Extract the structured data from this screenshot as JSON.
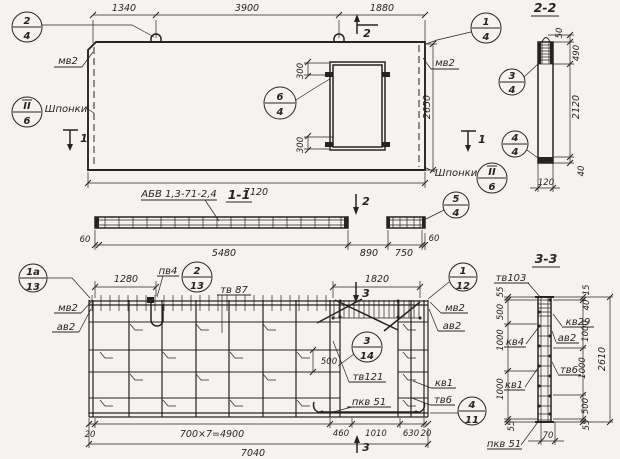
{
  "colors": {
    "ink": "#26241f",
    "paper": "#f4f3ef"
  },
  "plan_view": {
    "dims_top": [
      "1340",
      "3900",
      "1880"
    ],
    "dim_width": "7120",
    "dim_height": "2650",
    "dim_opening": [
      "300",
      "300"
    ],
    "label_mv2": "мв2",
    "label_keys_left": "Шпонки",
    "label_keys_right": "Шпонки",
    "callout_left": {
      "top": "2",
      "bottom": "4"
    },
    "callout_right": {
      "top": "1",
      "bottom": "4"
    },
    "callout_opening": {
      "top": "6",
      "bottom": "4"
    },
    "callout_keys": {
      "top": "II",
      "bottom": "6"
    },
    "cut1": "1",
    "cut2": "2"
  },
  "section_1_1": {
    "title": "1-1",
    "ref": "АБВ 1,3-71-2,4",
    "dims": [
      "60",
      "5480",
      "890",
      "750",
      "60"
    ],
    "callout": {
      "top": "5",
      "bottom": "4"
    }
  },
  "section_2_2": {
    "title": "2-2",
    "dims": {
      "d50": "50",
      "d490": "490",
      "d2120": "2120",
      "d40": "40",
      "d120": "120"
    },
    "callout_top": {
      "top": "3",
      "bottom": "4"
    },
    "callout_bottom": {
      "top": "4",
      "bottom": "4"
    }
  },
  "rebar_plan": {
    "dim_1280": "1280",
    "dim_1820": "1820",
    "dim_500": "500",
    "label_pv4": "пв4",
    "label_tv87": "тв 87",
    "label_tv121": "тв121",
    "label_kv1": "кв1",
    "label_tv6": "тв6",
    "label_pkv51": "пкв 51",
    "label_mv2": "мв2",
    "label_av2": "ав2",
    "callout_1a": {
      "top": "1а",
      "bottom": "13"
    },
    "callout_2": {
      "top": "2",
      "bottom": "13"
    },
    "callout_1": {
      "top": "1",
      "bottom": "12"
    },
    "callout_3": {
      "top": "3",
      "bottom": "14"
    },
    "callout_4": {
      "top": "4",
      "bottom": "11"
    },
    "dims_bottom": [
      "20",
      "700×7=4900",
      "460",
      "1010",
      "630",
      "20"
    ],
    "dim_total": "7040",
    "cut3": "3"
  },
  "section_3_3": {
    "title": "3-3",
    "label_tv103": "тв103",
    "label_kv4": "кв4",
    "label_kv1": "кв1",
    "label_pkv51": "пкв 51",
    "label_kv29": "кв29",
    "label_av2": "ав2",
    "label_tv6": "тв6",
    "dims_left": [
      "55",
      "500",
      "1000",
      "1000",
      "55"
    ],
    "dims_right": [
      "15",
      "40",
      "1000",
      "1000",
      "500",
      "55"
    ],
    "dim_total": "2610",
    "dim_width": "70"
  }
}
